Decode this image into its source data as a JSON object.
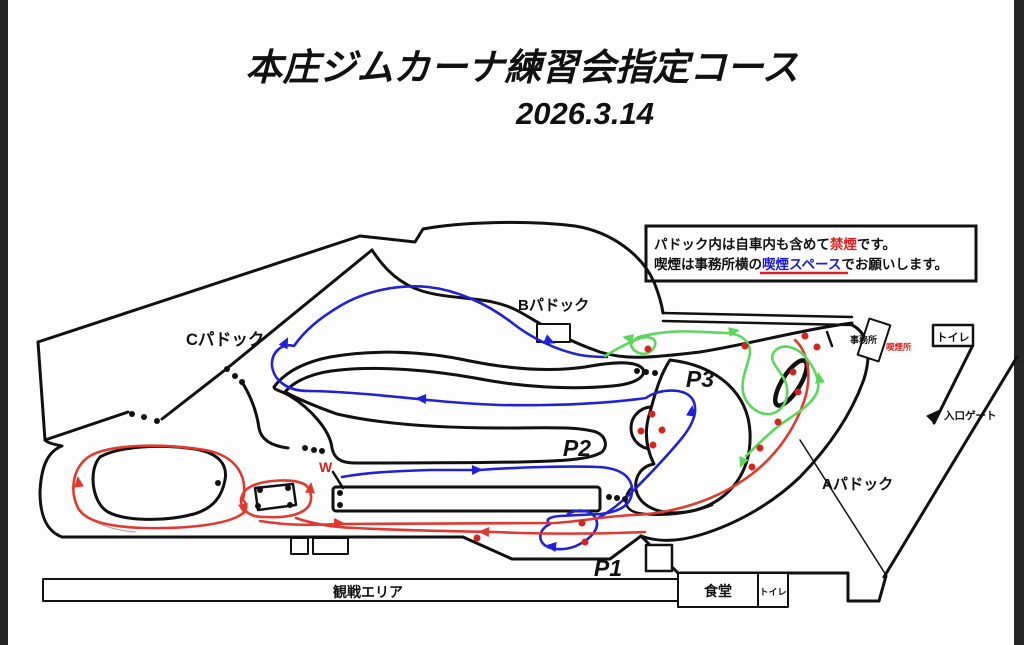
{
  "title": {
    "line1": "本庄ジムカーナ練習会指定コース",
    "line2": "2026.3.14"
  },
  "notice": {
    "line1_pre": "パドック内は自車内も含めて",
    "line1_red": "禁煙",
    "line1_post": "です。",
    "line2_pre": "喫煙は事務所横の",
    "line2_blue": "喫煙スペース",
    "line2_post": "でお願いします。"
  },
  "labels": {
    "paddock_c": "Cパドック",
    "paddock_b": "Bパドック",
    "paddock_a": "Aパドック",
    "p1": "P1",
    "p2": "P2",
    "p3": "P3",
    "w": "W",
    "spectator_area": "観戦エリア",
    "cafeteria": "食堂",
    "toilet_bottom": "トイレ",
    "toilet_top": "トイレ",
    "entrance_gate": "入口ゲート",
    "office": "事務所",
    "smoking_area": "喫煙所"
  },
  "colors": {
    "course_blue": "#2121d6",
    "course_red": "#e03a30",
    "course_green": "#5cd65c",
    "cone_red": "#d42420",
    "outline": "#111111",
    "notice_red": "#e02020",
    "notice_blue": "#1a1ae0"
  }
}
